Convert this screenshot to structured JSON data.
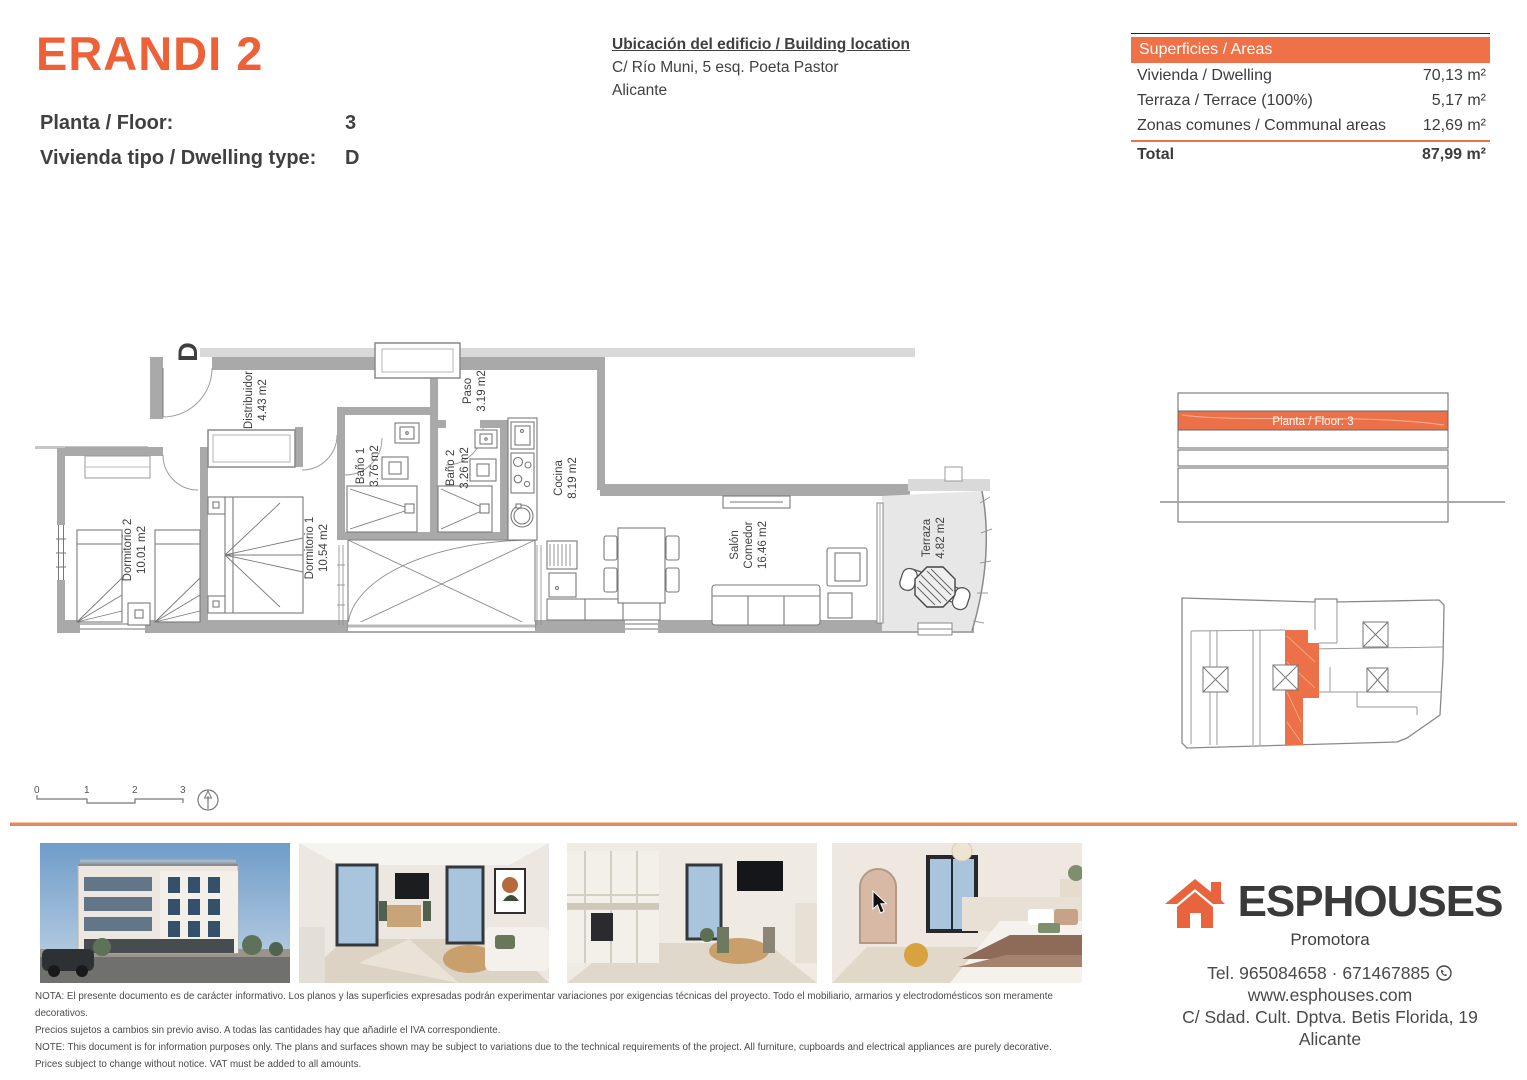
{
  "header": {
    "project_title": "ERANDI 2",
    "floor_label": "Planta / Floor:",
    "floor_value": "3",
    "dwelling_label": "Vivienda tipo / Dwelling type:",
    "dwelling_value": "D",
    "location_title": "Ubicación del edificio / Building location",
    "location_line1": "C/ Río Muni, 5 esq. Poeta Pastor",
    "location_line2": "Alicante"
  },
  "areas_table": {
    "header": "Superficies / Areas",
    "rows": [
      {
        "label": "Vivienda / Dwelling",
        "value": "70,13 m²"
      },
      {
        "label": "Terraza / Terrace (100%)",
        "value": "5,17 m²"
      },
      {
        "label": "Zonas comunes / Communal areas",
        "value": "12,69 m²"
      }
    ],
    "total_label": "Total",
    "total_value": "87,99 m²"
  },
  "floor_plan": {
    "dwelling_letter": "D",
    "rooms": [
      {
        "lines": [
          "Distribuidor",
          "4.43 m2"
        ]
      },
      {
        "lines": [
          "Dormitorio 2",
          "10.01 m2"
        ]
      },
      {
        "lines": [
          "Dormitorio 1",
          "10.54 m2"
        ]
      },
      {
        "lines": [
          "Baño 1",
          "3.76 m2"
        ]
      },
      {
        "lines": [
          "Baño 2",
          "3.26 m2"
        ]
      },
      {
        "lines": [
          "Paso",
          "3.19 m2"
        ]
      },
      {
        "lines": [
          "Cocina",
          "8.19 m2"
        ]
      },
      {
        "lines": [
          "Salón",
          "Comedor",
          "16.46 m2"
        ]
      },
      {
        "lines": [
          "Terraza",
          "4.82 m2"
        ]
      }
    ],
    "scale_ticks": [
      "0",
      "1",
      "2",
      "3"
    ]
  },
  "elevation": {
    "highlight_label": "Planta / Floor: 3"
  },
  "disclaimer": {
    "line1": "NOTA: El presente documento es de carácter informativo. Los planos y las superficies expresadas podrán experimentar variaciones por exigencias técnicas del proyecto. Todo el mobiliario, armarios y electrodomésticos son meramente decorativos.",
    "line2": "Precios sujetos a cambios sin previo aviso. A todas las cantidades hay que añadirle el IVA correspondiente.",
    "line3": "NOTE: This document is for information purposes only. The plans and surfaces shown may be subject to variations due to the technical requirements of the project. All furniture, cupboards and electrical appliances are purely decorative.",
    "line4": "Prices subject to change without notice. VAT must be added to all amounts."
  },
  "brand": {
    "name": "ESPHOUSES",
    "subtitle": "Promotora",
    "phone": "Tel. 965084658 · 671467885",
    "website": "www.esphouses.com",
    "address_line1": "C/ Sdad. Cult. Dptva. Betis Florida, 19",
    "address_line2": "Alicante"
  },
  "colors": {
    "brand_orange": "#ee6038",
    "table_orange": "#ee7148",
    "rule_orange": "#e08a5f",
    "wall_gray": "#a9a9a9",
    "terrace_gray": "#e7e7e7"
  }
}
